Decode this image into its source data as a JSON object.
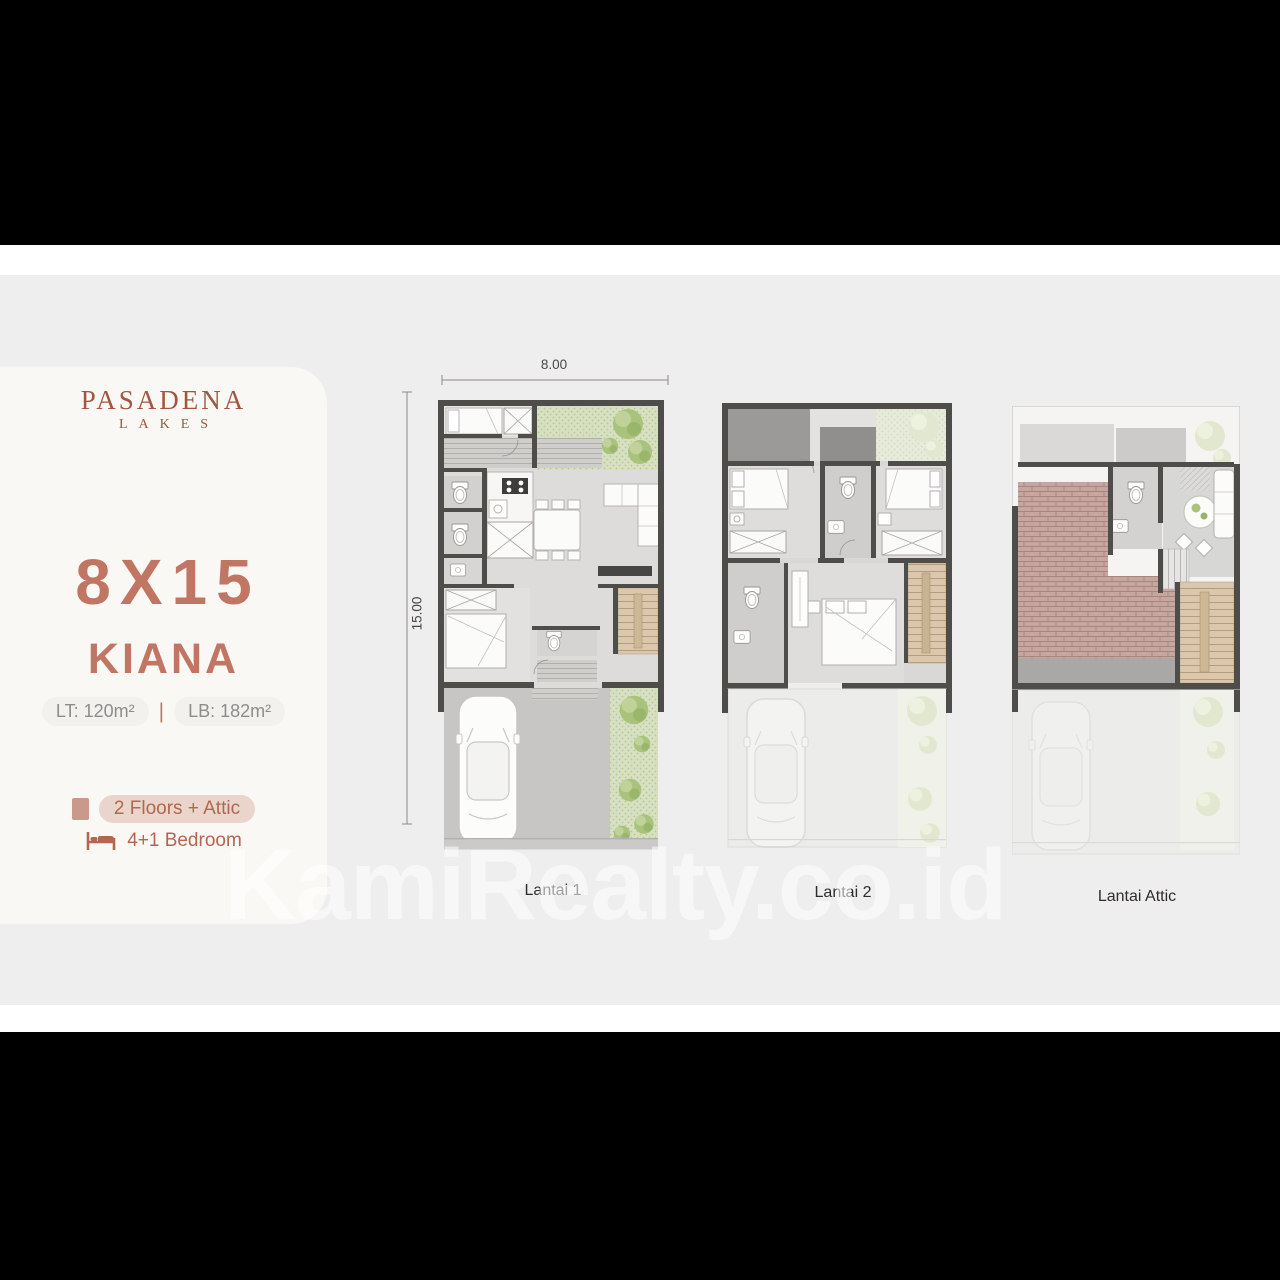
{
  "brand": {
    "line1": "PASADENA",
    "line2": "LAKES"
  },
  "unit": {
    "size": "8X15",
    "name": "KIANA",
    "land_area": "LT: 120m²",
    "separator": "|",
    "building_area": "LB: 182m²",
    "features": [
      {
        "icon": "building-icon",
        "label": "2 Floors + Attic"
      },
      {
        "icon": "bed-icon",
        "label": "4+1 Bedroom"
      }
    ]
  },
  "dimensions": {
    "width": "8.00",
    "height": "15.00"
  },
  "plans": [
    {
      "label": "Lantai 1"
    },
    {
      "label": "Lantai 2"
    },
    {
      "label": "Lantai Attic"
    }
  ],
  "watermark": "KamiRealty.co.id",
  "colors": {
    "accent": "#bf7260",
    "logo": "#a2553f",
    "page_background": "#efeeee",
    "card_background": "#faf8f5",
    "wall": "#4f4d49",
    "garden_green": "#d7e0c2",
    "stair_tan": "#dbc8ac",
    "roof_tile": "#c6a7a0"
  }
}
